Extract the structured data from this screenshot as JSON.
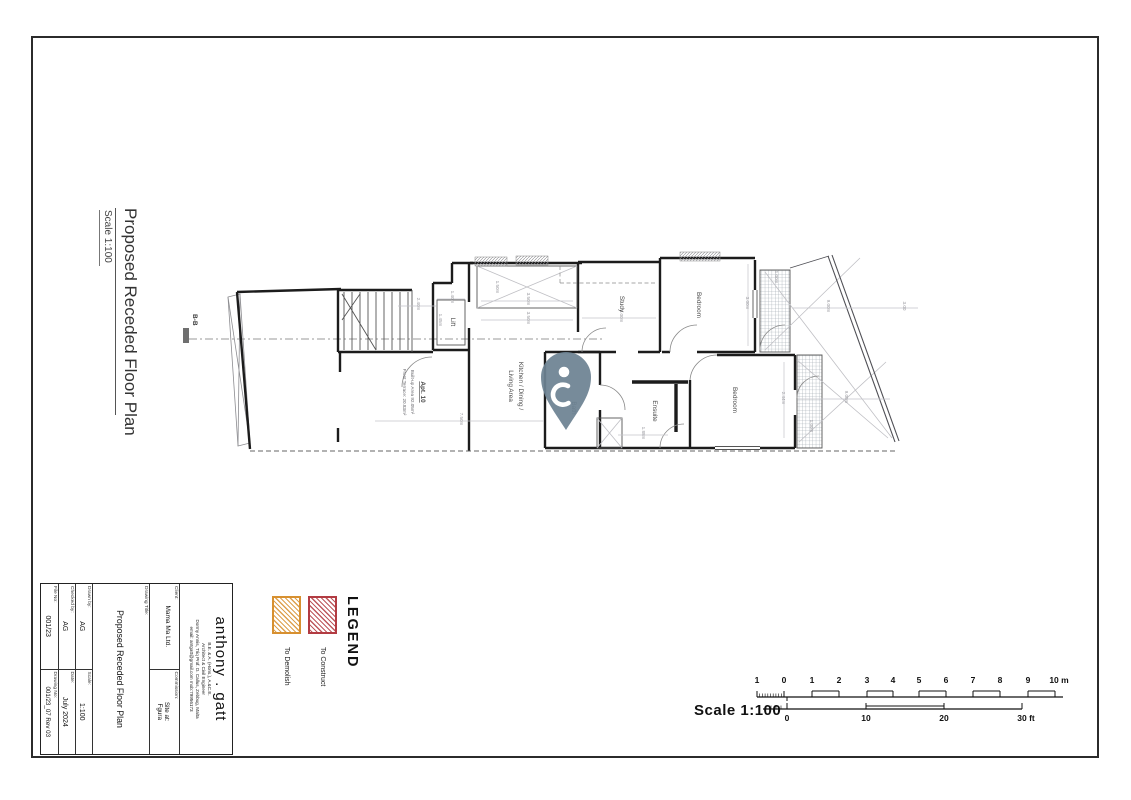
{
  "sheet": {
    "drawing_title_vertical": "Proposed Receded Floor Plan",
    "scale_note": "Scale 1:100",
    "section_marker": "B-B"
  },
  "plan": {
    "apartment": {
      "name": "Apt. 10",
      "area": "Built-up Area 92.05m²",
      "terrace": "Front Terrace: 20.83m²"
    },
    "rooms": {
      "lift": "Lift",
      "kitchen_line1": "Kitchen / Dining /",
      "kitchen_line2": "Living Area",
      "study": "Study",
      "bedroom_top": "Bedroom",
      "bedroom_bottom": "Bedroom",
      "bath": "Bath",
      "ensuite": "Ensuite"
    },
    "dimensions": {
      "stair_width": "2.40m",
      "lift_width": "1.40m",
      "lift_depth": "1.45m",
      "court_width_a": "3.50m",
      "court_width_b": "3.50m",
      "court_depth": "1.50m",
      "living_width": "7.50m",
      "study_width": "3.00m",
      "bedroom_top_depth": "3.00m",
      "balcony_top_width": "1.00m",
      "terrace_top_width": "9.00m",
      "terrace_top_ext": "3.00",
      "bedroom_bottom_depth": "2.44m",
      "balcony_bottom_width": "1.00m",
      "terrace_bottom_width": "9.00m",
      "ensuite_width": "1.88m"
    }
  },
  "legend": {
    "title": "LEGEND",
    "items": [
      {
        "label": "To Construct",
        "color": "#b23b42"
      },
      {
        "label": "To Demolish",
        "color": "#d79030"
      }
    ]
  },
  "scalebar": {
    "label": "Scale 1:100",
    "meters": [
      "1",
      "0",
      "1",
      "2",
      "3",
      "4",
      "5",
      "6",
      "7",
      "8",
      "9",
      "10 m"
    ],
    "feet": [
      "0",
      "10",
      "20",
      "30 ft"
    ]
  },
  "titleblock": {
    "architect": {
      "name": "anthony . gatt",
      "cred1": "B.E. & A. (Hons.), A.&C.E.",
      "cred2": "Architect & Civil Engineer",
      "cred3": "Dormy Annis, Triq Prof. D. Callus, Zebbug, Malta",
      "cred4": "email: antgatt@gmail.com  mob:79956173"
    },
    "client": {
      "label": "Client:",
      "value": "Mama Ma Ltd."
    },
    "commission": {
      "label": "Commission:",
      "value1": "Site at:",
      "value2": "Fgura"
    },
    "drawing_title": {
      "label": "Drawing Title:",
      "value": "Proposed Receded Floor Plan"
    },
    "drawn": {
      "label": "Drawn by:",
      "value": "AG"
    },
    "scale": {
      "label": "Scale:",
      "value": "1:100"
    },
    "checked": {
      "label": "Checked by:",
      "value": "AG"
    },
    "date": {
      "label": "Date:",
      "value": "July 2024"
    },
    "file_no": {
      "label": "File No:",
      "value": "001/23"
    },
    "drawing_no": {
      "label": "Drawing No:",
      "value": "001/23_07 Rev 03"
    }
  },
  "colors": {
    "construct": "#b23b42",
    "demolish": "#d79030",
    "pin": "#6d8292"
  }
}
